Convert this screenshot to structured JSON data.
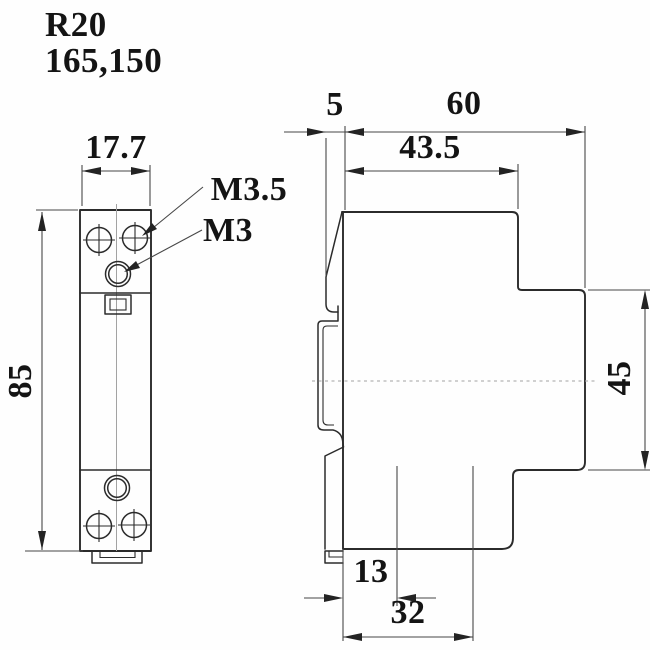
{
  "drawing": {
    "model": "R20",
    "part_number": "165,150",
    "colors": {
      "background": "#fefefe",
      "outline": "#2b2b2b",
      "dimension_lines": "#474747",
      "text": "#141414"
    },
    "front_view": {
      "width_mm": "17.7",
      "height_mm": "85",
      "upper_terminal_thread": "M3.5",
      "lower_terminal_thread": "M3"
    },
    "side_view": {
      "din_recess_depth_mm": "5",
      "total_depth_mm": "60",
      "body_depth_mm": "43.5",
      "front_block_height_mm": "45",
      "rail_offset_mm": "13",
      "rail_zone_width_mm": "32"
    }
  }
}
